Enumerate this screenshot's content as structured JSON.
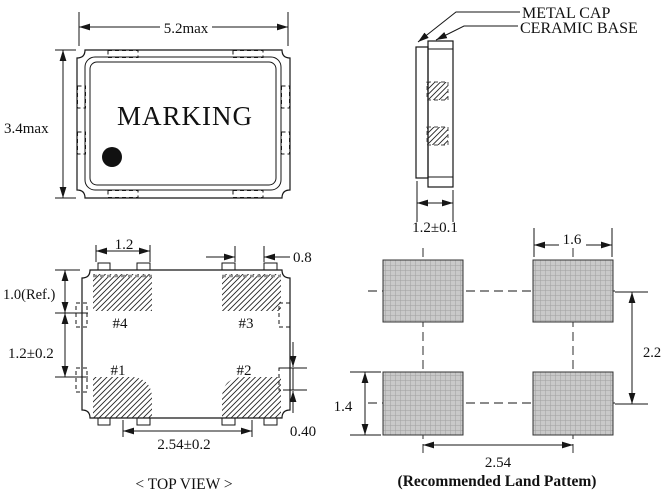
{
  "views": {
    "package_top": {
      "marking": "MARKING",
      "dim_width": "5.2max",
      "dim_height": "3.4max"
    },
    "side": {
      "label_metal_cap": "METAL CAP",
      "label_ceramic_base": "CERAMIC BASE",
      "dim_thickness": "1.2±0.1"
    },
    "top_view": {
      "caption": "< TOP VIEW >",
      "pad_labels": {
        "p1": "#1",
        "p2": "#2",
        "p3": "#3",
        "p4": "#4"
      },
      "dim_pad_width": "1.2",
      "dim_edge_gap": "0.8",
      "dim_ref_height": "1.0(Ref.)",
      "dim_row_pitch": "1.2±0.2",
      "dim_pad_pitch": "2.54±0.2",
      "dim_castellation": "0.40"
    },
    "land_pattern": {
      "caption": "(Recommended Land Pattem)",
      "dim_pad_width": "1.6",
      "dim_vertical_pitch": "2.2",
      "dim_pad_height": "1.4",
      "dim_horizontal_pitch": "2.54"
    }
  },
  "colors": {
    "line": "#161616",
    "land_pad_fill": "#c9c9c9",
    "land_pad_grid": "#a0a0a0",
    "hidden_edge_gray": "#8f8f8f",
    "background": "#ffffff"
  }
}
